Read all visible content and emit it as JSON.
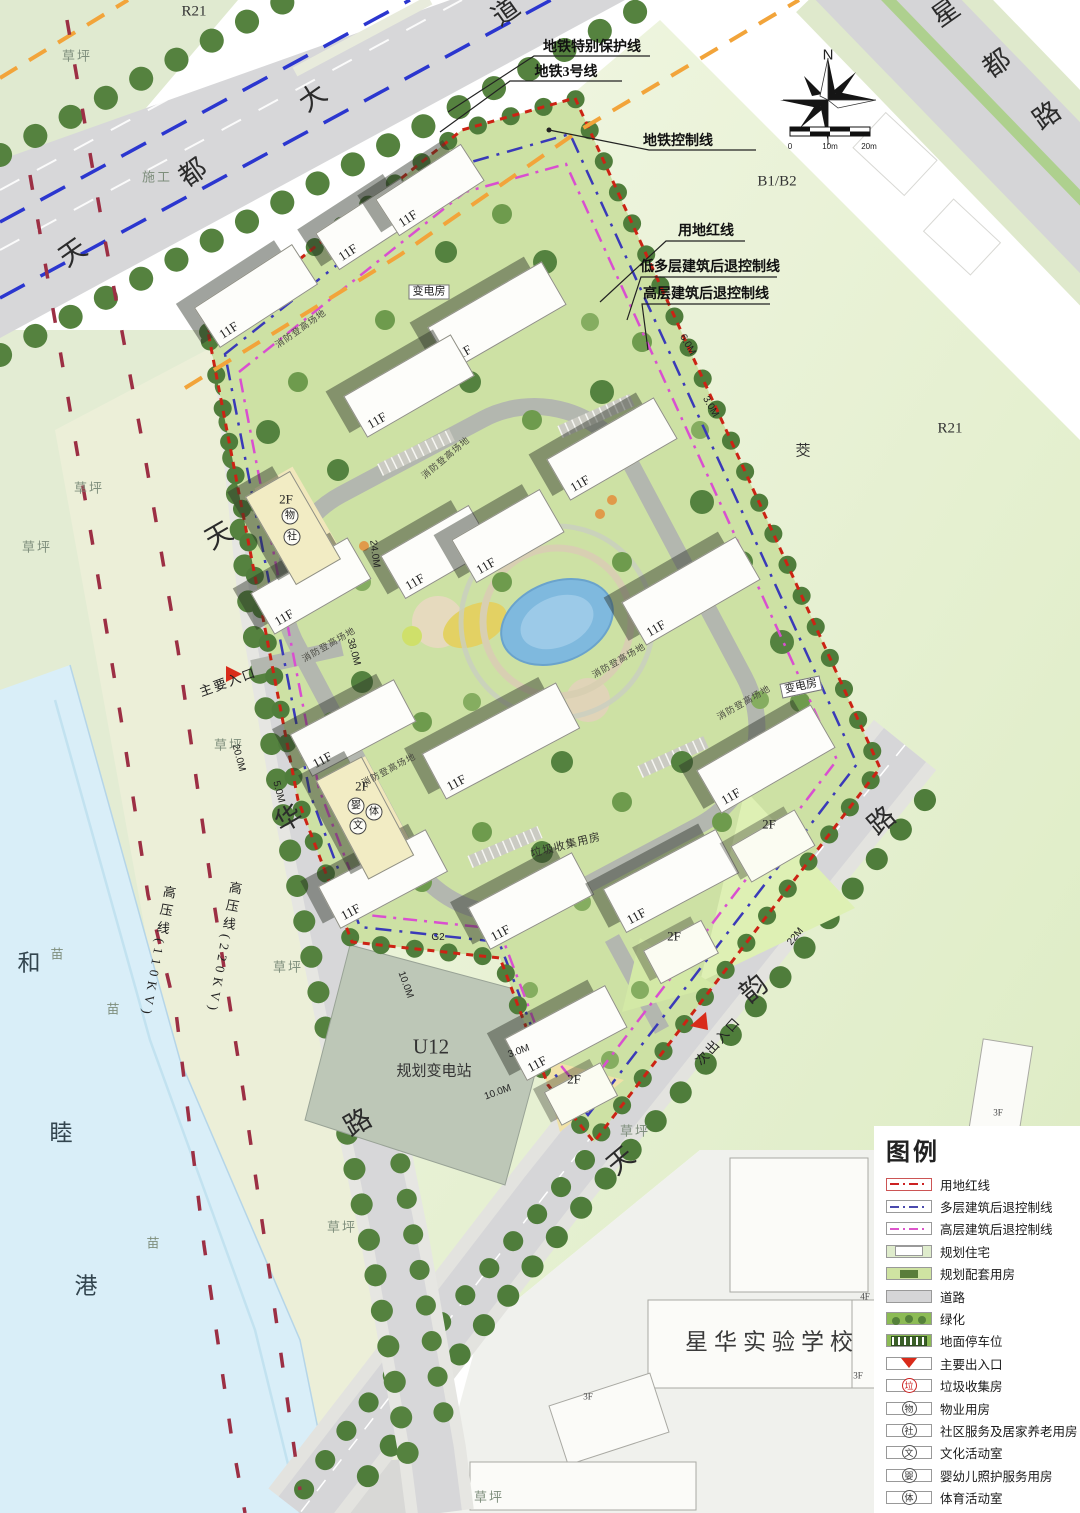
{
  "legend": {
    "title": "图例",
    "items": [
      {
        "swatch": "line-red",
        "label": "用地红线"
      },
      {
        "swatch": "line-blue",
        "label": "多层建筑后退控制线"
      },
      {
        "swatch": "line-mag",
        "label": "高层建筑后退控制线"
      },
      {
        "swatch": "res",
        "label": "规划住宅"
      },
      {
        "swatch": "support",
        "label": "规划配套用房"
      },
      {
        "swatch": "road",
        "label": "道路"
      },
      {
        "swatch": "green",
        "label": "绿化"
      },
      {
        "swatch": "parking",
        "label": "地面停车位"
      },
      {
        "swatch": "entry",
        "label": "主要出入口"
      },
      {
        "swatch": "circ-red",
        "char": "垃",
        "label": "垃圾收集房"
      },
      {
        "swatch": "circ",
        "char": "物",
        "label": "物业用房"
      },
      {
        "swatch": "circ",
        "char": "社",
        "label": "社区服务及居家养老用房"
      },
      {
        "swatch": "circ",
        "char": "文",
        "label": "文化活动室"
      },
      {
        "swatch": "circ",
        "char": "婴",
        "label": "婴幼儿照护服务用房"
      },
      {
        "swatch": "circ",
        "char": "体",
        "label": "体育活动室"
      }
    ]
  },
  "compass": {
    "north": "N",
    "scale_ticks": [
      "0",
      "10m",
      "20m"
    ]
  },
  "colors": {
    "boundary_red": "#cc2314",
    "setback_blue": "#3a3ab8",
    "setback_magenta": "#d94fd0",
    "metro_blue": "#2b36cf",
    "metro_control_orange": "#f2a43a",
    "hv_line_red": "#9c2f44",
    "road_gray": "#d6d6d8",
    "site_green": "#cde1a4",
    "river_blue": "#d9eef8",
    "tree_green": "#4f7d3b"
  },
  "map": {
    "labels": [
      {
        "t": "地铁特别保护线",
        "x": 592,
        "y": 48,
        "c": "callout"
      },
      {
        "t": "地铁3号线",
        "x": 566,
        "y": 73,
        "c": "callout"
      },
      {
        "t": "地铁控制线",
        "x": 678,
        "y": 142,
        "c": "callout"
      },
      {
        "t": "用地红线",
        "x": 706,
        "y": 232,
        "c": "callout"
      },
      {
        "t": "低多层建筑后退控制线",
        "x": 710,
        "y": 268,
        "c": "callout"
      },
      {
        "t": "高层建筑后退控制线",
        "x": 706,
        "y": 295,
        "c": "callout"
      },
      {
        "t": "R21",
        "x": 194,
        "y": 12,
        "c": "parcel"
      },
      {
        "t": "R21",
        "x": 950,
        "y": 429,
        "c": "parcel"
      },
      {
        "t": "B1/B2",
        "x": 777,
        "y": 182,
        "c": "parcel"
      },
      {
        "t": "U12",
        "x": 431,
        "y": 1047,
        "c": "parcel-lg"
      },
      {
        "t": "规划变电站",
        "x": 434,
        "y": 1072,
        "c": "parcel"
      },
      {
        "t": "星华实验学校",
        "x": 772,
        "y": 1342,
        "c": "school"
      },
      {
        "t": "茭",
        "x": 803,
        "y": 452,
        "c": "parcel"
      },
      {
        "t": "天",
        "x": 73,
        "y": 253,
        "r": -35,
        "c": "rc"
      },
      {
        "t": "都",
        "x": 193,
        "y": 173,
        "r": -35,
        "c": "rc"
      },
      {
        "t": "大",
        "x": 313,
        "y": 98,
        "r": -35,
        "c": "rc"
      },
      {
        "t": "道",
        "x": 506,
        "y": 12,
        "r": -35,
        "c": "rc"
      },
      {
        "t": "星",
        "x": 946,
        "y": 13,
        "r": -35,
        "c": "rc"
      },
      {
        "t": "都",
        "x": 997,
        "y": 64,
        "r": -35,
        "c": "rc"
      },
      {
        "t": "路",
        "x": 1047,
        "y": 116,
        "r": -35,
        "c": "rc"
      },
      {
        "t": "天",
        "x": 219,
        "y": 536,
        "r": -30,
        "c": "rc"
      },
      {
        "t": "华",
        "x": 289,
        "y": 819,
        "r": -30,
        "c": "rc"
      },
      {
        "t": "路",
        "x": 358,
        "y": 1123,
        "r": -30,
        "c": "rc"
      },
      {
        "t": "天",
        "x": 621,
        "y": 1161,
        "r": -40,
        "c": "rc"
      },
      {
        "t": "韵",
        "x": 754,
        "y": 989,
        "r": -40,
        "c": "rc"
      },
      {
        "t": "路",
        "x": 882,
        "y": 821,
        "r": -40,
        "c": "rc"
      },
      {
        "t": "和",
        "x": 29,
        "y": 963,
        "c": "rvc"
      },
      {
        "t": "睦",
        "x": 61,
        "y": 1133,
        "c": "rvc"
      },
      {
        "t": "港",
        "x": 86,
        "y": 1286,
        "c": "rvc"
      },
      {
        "t": "草坪",
        "x": 77,
        "y": 56,
        "c": "grass"
      },
      {
        "t": "草坪",
        "x": 89,
        "y": 488,
        "c": "grass"
      },
      {
        "t": "草坪",
        "x": 37,
        "y": 547,
        "c": "grass"
      },
      {
        "t": "草坪",
        "x": 229,
        "y": 745,
        "c": "grass"
      },
      {
        "t": "草坪",
        "x": 288,
        "y": 967,
        "c": "grass"
      },
      {
        "t": "草坪",
        "x": 342,
        "y": 1227,
        "c": "grass"
      },
      {
        "t": "草坪",
        "x": 635,
        "y": 1131,
        "c": "grass"
      },
      {
        "t": "草坪",
        "x": 489,
        "y": 1497,
        "c": "grass"
      },
      {
        "t": "施工",
        "x": 157,
        "y": 177,
        "c": "grass"
      },
      {
        "t": "苗",
        "x": 58,
        "y": 954,
        "c": "grass"
      },
      {
        "t": "苗",
        "x": 114,
        "y": 1009,
        "c": "grass"
      },
      {
        "t": "苗",
        "x": 154,
        "y": 1243,
        "c": "grass"
      },
      {
        "t": "高压线(220KV)",
        "x": 224,
        "y": 948,
        "r": 10,
        "c": "hv"
      },
      {
        "t": "高压线(110KV)",
        "x": 158,
        "y": 952,
        "r": 10,
        "c": "hv"
      },
      {
        "t": "20.0M",
        "x": 238,
        "y": 758,
        "r": 75,
        "c": "dim"
      },
      {
        "t": "5.0M",
        "x": 278,
        "y": 792,
        "r": 75,
        "c": "dim"
      },
      {
        "t": "24.0M",
        "x": 374,
        "y": 554,
        "r": 82,
        "c": "dim"
      },
      {
        "t": "38.0M",
        "x": 353,
        "y": 652,
        "r": 75,
        "c": "dim"
      },
      {
        "t": "6.0M",
        "x": 687,
        "y": 345,
        "r": 60,
        "c": "dim"
      },
      {
        "t": "3.0M",
        "x": 710,
        "y": 407,
        "r": 60,
        "c": "dim"
      },
      {
        "t": "22M",
        "x": 796,
        "y": 937,
        "r": -50,
        "c": "dim"
      },
      {
        "t": "3.0M",
        "x": 519,
        "y": 1052,
        "r": -20,
        "c": "dim"
      },
      {
        "t": "10.0M",
        "x": 498,
        "y": 1093,
        "r": -20,
        "c": "dim"
      },
      {
        "t": "10.0M",
        "x": 405,
        "y": 985,
        "r": 70,
        "c": "dim"
      },
      {
        "t": "G2",
        "x": 438,
        "y": 938,
        "c": "dim"
      },
      {
        "t": "消防登高场地",
        "x": 301,
        "y": 329,
        "r": -35,
        "c": "fire"
      },
      {
        "t": "消防登高场地",
        "x": 446,
        "y": 458,
        "r": -40,
        "c": "fire"
      },
      {
        "t": "消防登高场地",
        "x": 389,
        "y": 770,
        "r": -28,
        "c": "fire"
      },
      {
        "t": "消防登高场地",
        "x": 619,
        "y": 661,
        "r": -30,
        "c": "fire"
      },
      {
        "t": "消防登高场地",
        "x": 744,
        "y": 703,
        "r": -30,
        "c": "fire"
      },
      {
        "t": "消防登高场地",
        "x": 329,
        "y": 645,
        "r": -30,
        "c": "fire"
      },
      {
        "t": "垃圾收集用房",
        "x": 566,
        "y": 846,
        "r": -14,
        "c": "util"
      },
      {
        "t": "变电房",
        "x": 429,
        "y": 292,
        "c": "house"
      },
      {
        "t": "变电房",
        "x": 801,
        "y": 687,
        "r": -12,
        "c": "house"
      },
      {
        "t": "主要入口",
        "x": 228,
        "y": 682,
        "r": -20,
        "c": "entr"
      },
      {
        "t": "次出入口",
        "x": 718,
        "y": 1041,
        "r": -48,
        "c": "entr"
      },
      {
        "t": "物",
        "x": 290,
        "y": 516,
        "c": "circ"
      },
      {
        "t": "社",
        "x": 292,
        "y": 537,
        "c": "circ"
      },
      {
        "t": "婴",
        "x": 356,
        "y": 806,
        "c": "circ"
      },
      {
        "t": "文",
        "x": 358,
        "y": 826,
        "c": "circ"
      },
      {
        "t": "体",
        "x": 374,
        "y": 812,
        "c": "circ"
      },
      {
        "t": "2F",
        "x": 286,
        "y": 499,
        "c": "flab"
      },
      {
        "t": "2F",
        "x": 362,
        "y": 786,
        "c": "flab"
      },
      {
        "t": "2F",
        "x": 769,
        "y": 824,
        "c": "flab"
      },
      {
        "t": "2F",
        "x": 674,
        "y": 936,
        "c": "flab"
      },
      {
        "t": "2F",
        "x": 574,
        "y": 1079,
        "c": "flab"
      },
      {
        "t": "4F",
        "x": 865,
        "y": 1297,
        "c": "floor"
      },
      {
        "t": "3F",
        "x": 858,
        "y": 1376,
        "c": "floor"
      },
      {
        "t": "3F",
        "x": 588,
        "y": 1397,
        "c": "floor"
      },
      {
        "t": "3F",
        "x": 998,
        "y": 1113,
        "c": "floor"
      },
      {
        "t": "N",
        "x": 828,
        "y": 55,
        "c": "cnorth"
      },
      {
        "t": "0",
        "x": 790,
        "y": 147,
        "c": "slab"
      },
      {
        "t": "10m",
        "x": 830,
        "y": 147,
        "c": "slab"
      },
      {
        "t": "20m",
        "x": 869,
        "y": 147,
        "c": "slab"
      }
    ],
    "buildings": [
      {
        "x": 256,
        "y": 296,
        "w": 115,
        "h": 46,
        "r": -33,
        "t": "11F"
      },
      {
        "x": 370,
        "y": 224,
        "w": 100,
        "h": 42,
        "r": -33,
        "t": "11F"
      },
      {
        "x": 430,
        "y": 190,
        "w": 100,
        "h": 42,
        "r": -33,
        "t": "11F"
      },
      {
        "x": 497,
        "y": 316,
        "w": 130,
        "h": 48,
        "r": -30,
        "t": "11F"
      },
      {
        "x": 409,
        "y": 386,
        "w": 122,
        "h": 46,
        "r": -30,
        "t": "11F"
      },
      {
        "x": 612,
        "y": 449,
        "w": 122,
        "h": 46,
        "r": -30,
        "t": "11F"
      },
      {
        "x": 437,
        "y": 552,
        "w": 100,
        "h": 48,
        "r": -30,
        "t": "11F"
      },
      {
        "x": 508,
        "y": 536,
        "w": 100,
        "h": 48,
        "r": -30,
        "t": "11F"
      },
      {
        "x": 691,
        "y": 591,
        "w": 130,
        "h": 48,
        "r": -30,
        "t": "11F"
      },
      {
        "x": 311,
        "y": 586,
        "w": 110,
        "h": 46,
        "r": -30,
        "t": "11F"
      },
      {
        "x": 353,
        "y": 728,
        "w": 116,
        "h": 46,
        "r": -28,
        "t": "11F"
      },
      {
        "x": 501,
        "y": 741,
        "w": 150,
        "h": 50,
        "r": -28,
        "t": "11F"
      },
      {
        "x": 766,
        "y": 759,
        "w": 130,
        "h": 48,
        "r": -30,
        "t": "11F"
      },
      {
        "x": 383,
        "y": 879,
        "w": 120,
        "h": 46,
        "r": -28,
        "t": "11F"
      },
      {
        "x": 531,
        "y": 901,
        "w": 116,
        "h": 46,
        "r": -28,
        "t": "11F"
      },
      {
        "x": 671,
        "y": 881,
        "w": 126,
        "h": 48,
        "r": -28,
        "t": "11F"
      },
      {
        "x": 566,
        "y": 1033,
        "w": 112,
        "h": 46,
        "r": -28,
        "t": "11F"
      },
      {
        "x": 293,
        "y": 528,
        "w": 50,
        "h": 100,
        "r": -30,
        "t": "",
        "c": "tan"
      },
      {
        "x": 365,
        "y": 818,
        "w": 50,
        "h": 110,
        "r": -28,
        "t": "",
        "c": "tan"
      },
      {
        "x": 773,
        "y": 846,
        "w": 72,
        "h": 40,
        "r": -30,
        "t": "",
        "c": "lite"
      },
      {
        "x": 681,
        "y": 952,
        "w": 64,
        "h": 36,
        "r": -28,
        "t": "",
        "c": "lite"
      },
      {
        "x": 581,
        "y": 1094,
        "w": 62,
        "h": 36,
        "r": -28,
        "t": "",
        "c": "lite"
      }
    ]
  }
}
